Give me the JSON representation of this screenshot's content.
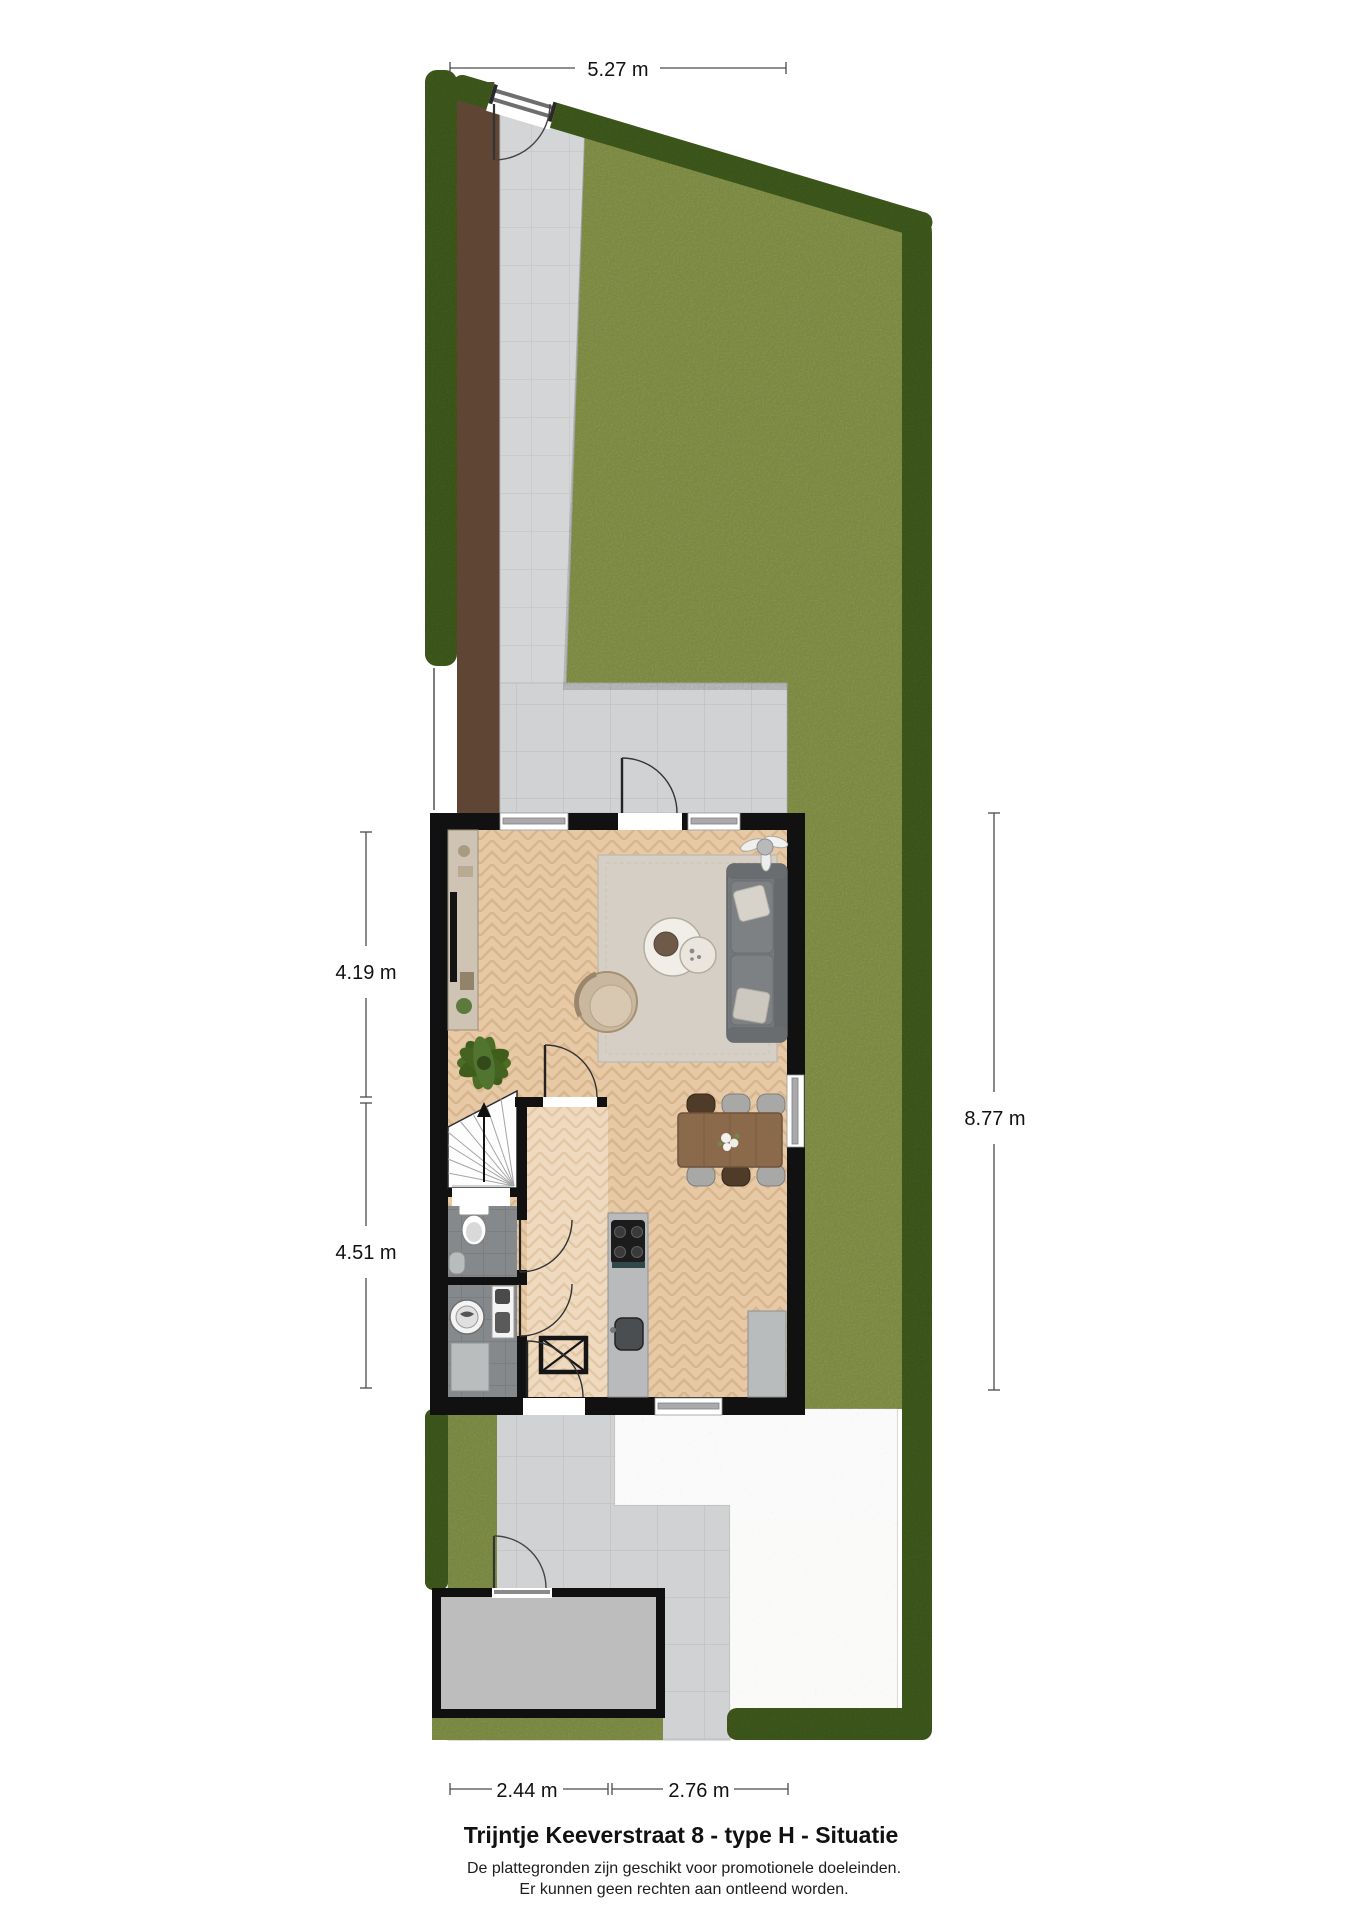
{
  "document": {
    "title": "Trijntje Keeverstraat 8 - type H - Situatie",
    "disclaimer_line1": "De plattegronden zijn geschikt voor promotionele doeleinden.",
    "disclaimer_line2": "Er kunnen geen rechten aan ontleend worden."
  },
  "dimensions": {
    "top": "5.27 m",
    "left_upper": "4.19 m",
    "left_lower": "4.51 m",
    "right": "8.77 m",
    "bottom_left": "2.44 m",
    "bottom_right": "2.76 m"
  },
  "palette": {
    "lawn": "#93a351",
    "hedge": "#46631f",
    "soil": "#5f4533",
    "paving": "#d4d5d6",
    "terrace_paving": "#d1d2d3",
    "gravel": "#dededb",
    "wall": "#111111",
    "wood_floor": "#e7c9a5",
    "hall_floor": "#efdabf",
    "bath_floor": "#85898b",
    "rug": "#d5cfc6",
    "sofa": "#74787b",
    "dining_table": "#8b6a4b",
    "shed_floor": "#bdbdbd"
  }
}
